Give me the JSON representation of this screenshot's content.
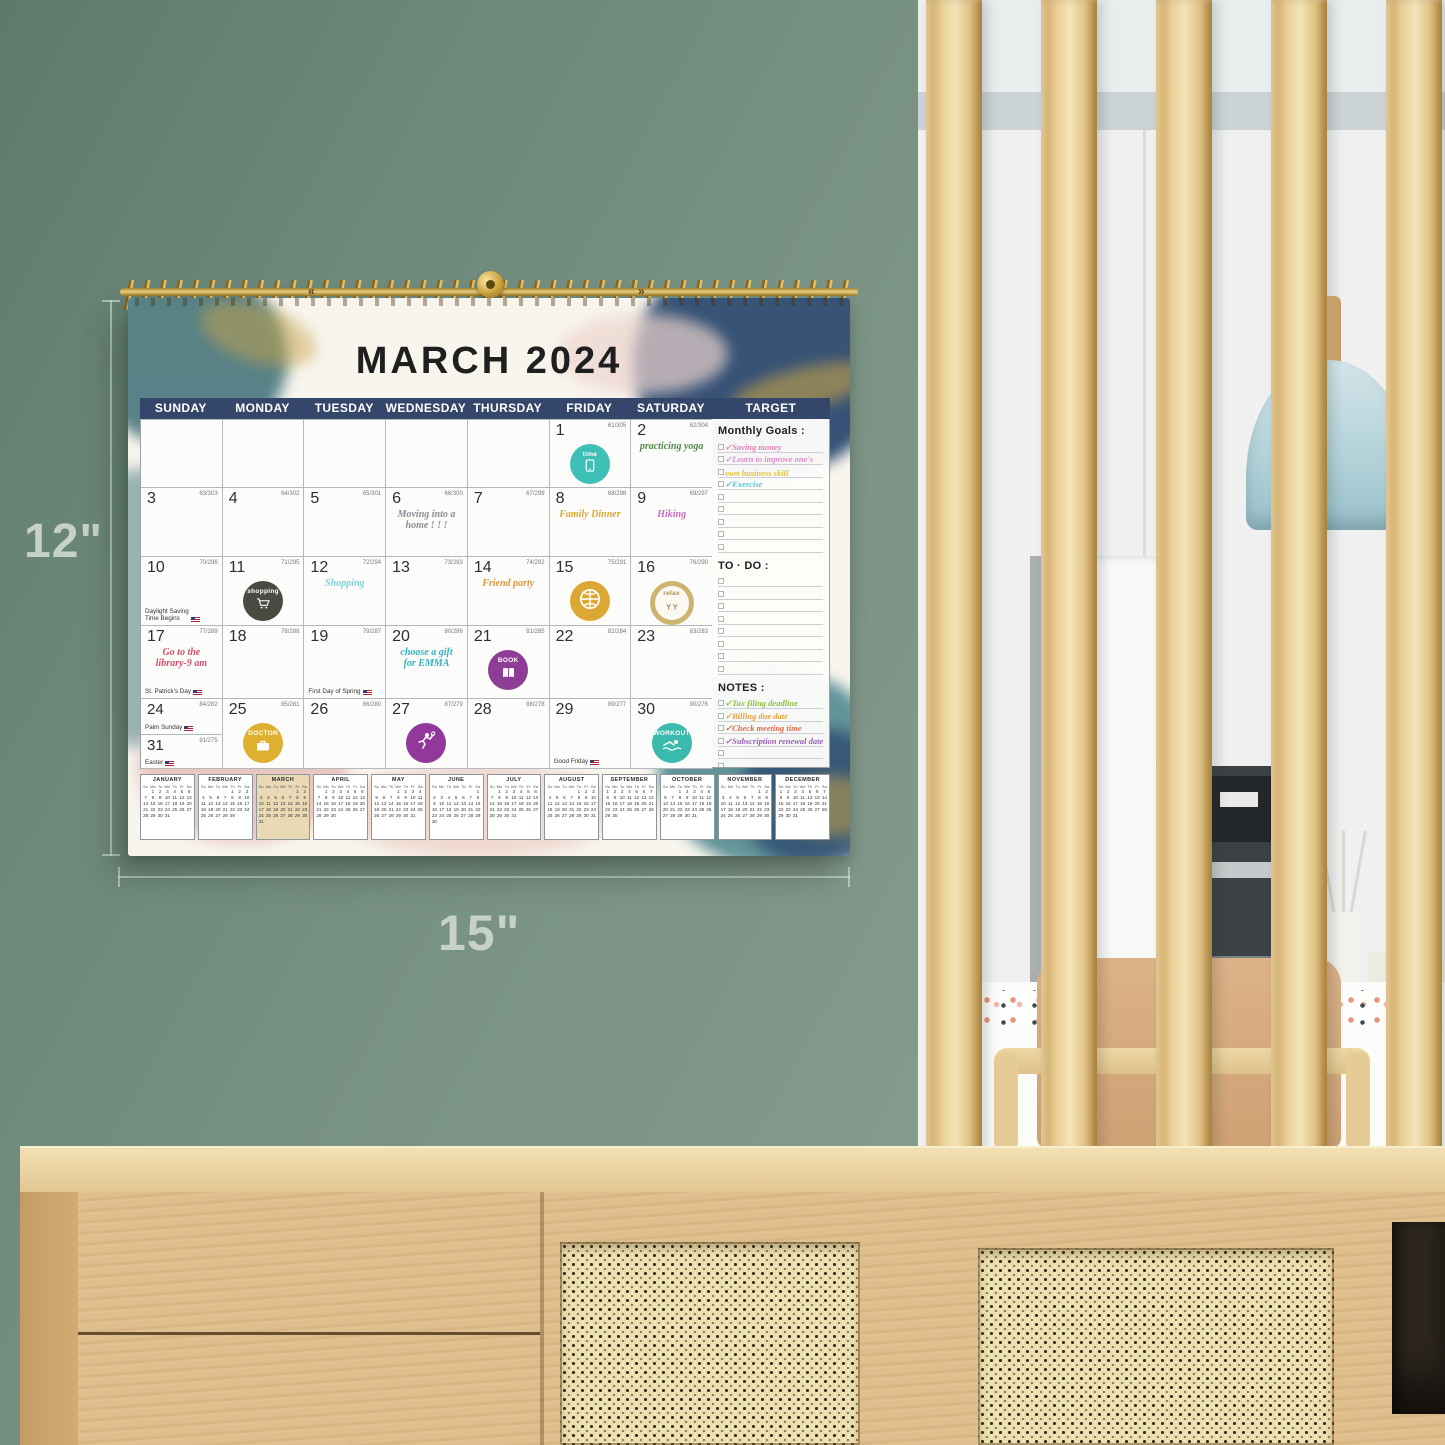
{
  "scene": {
    "height_label": "12\"",
    "width_label": "15\""
  },
  "binding": {
    "marks": [
      "«",
      "»"
    ]
  },
  "calendar": {
    "title": "MARCH 2024",
    "day_headers": [
      "SUNDAY",
      "MONDAY",
      "TUESDAY",
      "WEDNESDAY",
      "THURSDAY",
      "FRIDAY",
      "SATURDAY",
      "TARGET"
    ],
    "header_color": "#35466b",
    "weeks": [
      [
        null,
        null,
        null,
        null,
        null,
        {
          "day": "1",
          "code": "61/305",
          "sticker": "time"
        },
        {
          "day": "2",
          "code": "62/304",
          "note": {
            "text": "practicing yoga",
            "color": "#4e8c46"
          }
        }
      ],
      [
        {
          "day": "3",
          "code": "63/303"
        },
        {
          "day": "4",
          "code": "64/302"
        },
        {
          "day": "5",
          "code": "65/301"
        },
        {
          "day": "6",
          "code": "66/300",
          "note": {
            "text": "Moving into a\nhome !  !  !",
            "color": "#8c8c96"
          }
        },
        {
          "day": "7",
          "code": "67/299"
        },
        {
          "day": "8",
          "code": "68/298",
          "note": {
            "text": "Family Dinner",
            "color": "#d9a833"
          }
        },
        {
          "day": "9",
          "code": "69/297",
          "note": {
            "text": "Hiking",
            "color": "#d069c0"
          }
        }
      ],
      [
        {
          "day": "10",
          "code": "70/296",
          "holiday": {
            "text": "Daylight Saving\nTime Begins",
            "flag": true
          }
        },
        {
          "day": "11",
          "code": "71/295",
          "sticker": "shopping"
        },
        {
          "day": "12",
          "code": "72/294",
          "note": {
            "text": "Shopping",
            "color": "#7fd0de"
          }
        },
        {
          "day": "13",
          "code": "73/293"
        },
        {
          "day": "14",
          "code": "74/292",
          "note": {
            "text": "Friend party",
            "color": "#e09840"
          }
        },
        {
          "day": "15",
          "code": "75/291",
          "sticker": "basketball"
        },
        {
          "day": "16",
          "code": "76/290",
          "sticker": "relax"
        }
      ],
      [
        {
          "day": "17",
          "code": "77/289",
          "note": {
            "text": "Go to the\nlibrary-9 am",
            "color": "#d4506e"
          },
          "holiday": {
            "text": "St. Patrick's Day",
            "flag": true
          }
        },
        {
          "day": "18",
          "code": "78/288"
        },
        {
          "day": "19",
          "code": "79/287",
          "holiday": {
            "text": "First Day of Spring",
            "flag": true
          }
        },
        {
          "day": "20",
          "code": "80/286",
          "note": {
            "text": "choose a gift\nfor EMMA",
            "color": "#2fb5c4"
          }
        },
        {
          "day": "21",
          "code": "81/285",
          "sticker": "book"
        },
        {
          "day": "22",
          "code": "82/284"
        },
        {
          "day": "23",
          "code": "83/283"
        }
      ],
      [
        {
          "day": "24",
          "code": "84/282",
          "holiday": {
            "text": "Palm Sunday",
            "flag": true
          },
          "second": {
            "day": "31",
            "code": "91/275",
            "holiday": {
              "text": "Easter",
              "flag": true
            }
          }
        },
        {
          "day": "25",
          "code": "85/281",
          "sticker": "doctor"
        },
        {
          "day": "26",
          "code": "86/280"
        },
        {
          "day": "27",
          "code": "87/279",
          "sticker": "badminton"
        },
        {
          "day": "28",
          "code": "88/278"
        },
        {
          "day": "29",
          "code": "89/277",
          "holiday": {
            "text": "Good Friday",
            "flag": true
          }
        },
        {
          "day": "30",
          "code": "90/276",
          "sticker": "workout"
        }
      ]
    ],
    "stickers": {
      "time": {
        "bg": "#3ec0b6",
        "label": "time",
        "label_color": "#ffffff",
        "icon": "phone"
      },
      "shopping": {
        "bg": "#4a4a43",
        "label": "shopping",
        "label_color": "#ffffff",
        "icon": "cart"
      },
      "basketball": {
        "bg": "#dca733",
        "icon": "basketball"
      },
      "relax": {
        "bg": "#faf8f1",
        "ring": "#cbb370",
        "label": "relax",
        "label_color": "#a8904d",
        "icon": "cheers"
      },
      "book": {
        "bg": "#8e3d96",
        "label": "BOOK",
        "label_color": "#ffffff",
        "icon": "book"
      },
      "doctor": {
        "bg": "#ddb02f",
        "label": "DOCTOR",
        "label_color": "#ffffff",
        "icon": "briefcase"
      },
      "badminton": {
        "bg": "#93389b",
        "icon": "badminton"
      },
      "workout": {
        "bg": "#3bb9ad",
        "label": "WORKOUT",
        "label_color": "#ffffff",
        "icon": "swimmer"
      }
    },
    "sidebar": {
      "target_label": "TARGET",
      "monthly_goals_label": "Monthly Goals :",
      "goals": [
        {
          "text": "Saving money",
          "color": "#e87fb4",
          "checked": true
        },
        {
          "text": "Learn to improve one's",
          "color": "#df8cc8",
          "checked": true
        },
        {
          "text": "own business skill",
          "color": "#e3c23f",
          "checked": false
        },
        {
          "text": "Exercise",
          "color": "#5bc4cf",
          "checked": true
        }
      ],
      "goals_empty_lines": 5,
      "todo_label": "TO · DO :",
      "todo_empty_lines": 8,
      "notes_label": "NOTES :",
      "notes": [
        {
          "text": "Tax filing deadline",
          "color": "#8cbf3f",
          "checked": true
        },
        {
          "text": "Billing due date",
          "color": "#e8a23c",
          "checked": true
        },
        {
          "text": "Check meeting time",
          "color": "#e06a4a",
          "checked": true
        },
        {
          "text": "Subscription renewal date",
          "color": "#9a5fb5",
          "checked": true
        }
      ],
      "notes_empty_lines": 4
    },
    "mini_calendar": {
      "dow": [
        "Su",
        "Mo",
        "Tu",
        "We",
        "Th",
        "Fr",
        "Sa"
      ],
      "months": [
        {
          "name": "JANUARY",
          "first_dow": 1,
          "days": 31
        },
        {
          "name": "FEBRUARY",
          "first_dow": 4,
          "days": 29
        },
        {
          "name": "MARCH",
          "first_dow": 5,
          "days": 31,
          "highlight": true
        },
        {
          "name": "APRIL",
          "first_dow": 1,
          "days": 30
        },
        {
          "name": "MAY",
          "first_dow": 3,
          "days": 31
        },
        {
          "name": "JUNE",
          "first_dow": 6,
          "days": 30
        },
        {
          "name": "JULY",
          "first_dow": 1,
          "days": 31
        },
        {
          "name": "AUGUST",
          "first_dow": 4,
          "days": 31
        },
        {
          "name": "SEPTEMBER",
          "first_dow": 0,
          "days": 30
        },
        {
          "name": "OCTOBER",
          "first_dow": 2,
          "days": 31
        },
        {
          "name": "NOVEMBER",
          "first_dow": 5,
          "days": 30
        },
        {
          "name": "DECEMBER",
          "first_dow": 0,
          "days": 31
        }
      ]
    }
  }
}
